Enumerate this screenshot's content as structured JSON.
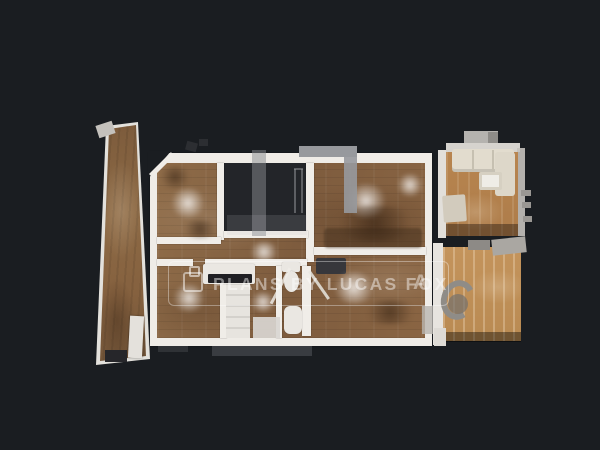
{
  "canvas": {
    "background_color": "#1a1d21",
    "description": "Top-down 3D dollhouse floor-plan scan of an apartment"
  },
  "watermark": {
    "text": "PLANS BY LUCAS FOX",
    "partial_letter": "A",
    "icon": "photos-icon",
    "text_color": "#ffffff",
    "opacity": 0.45,
    "frame": "rounded-rectangle outline",
    "large_logo_color": "#97999d"
  },
  "palette": {
    "wood_main": "#8a6746",
    "wood_living": "#b2804f",
    "wood_pale": "#c09057",
    "wall_white": "#efece7",
    "void_dark": "#232529"
  },
  "scene": {
    "rooms": [
      "terrace-strip",
      "bedroom-top-left",
      "unscanned-void",
      "bedroom-top-right",
      "room-bottom-left",
      "kitchen-bathroom",
      "bedroom-bottom-right",
      "living-room-right",
      "room-bottom-far-right"
    ]
  }
}
